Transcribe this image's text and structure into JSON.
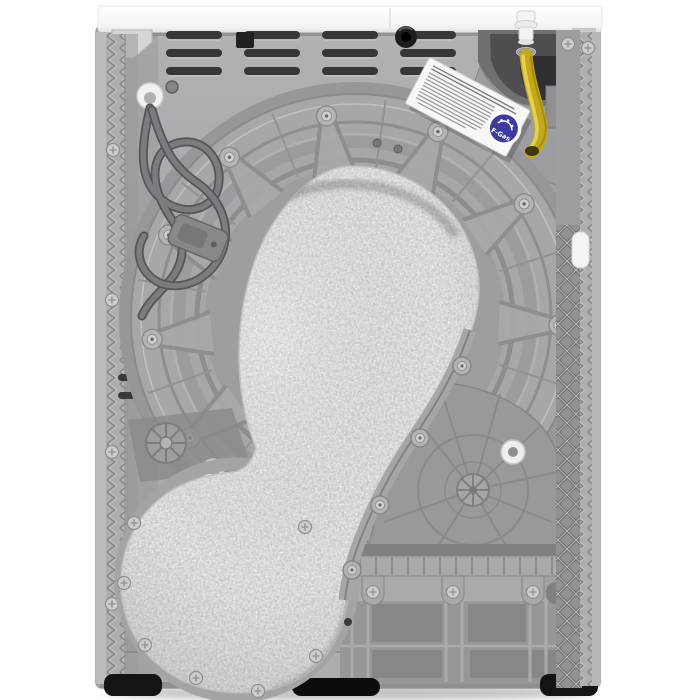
{
  "image": {
    "alt": "Rear view of a white freestanding tumble dryer: grey metal back panel with vent slots, large round drum housing covered by a grey felt air duct that sweeps down to a round felt pad at the lower left, coiled grey power cord on the upper left, yellow drain hose and dark heat-pump recess at the upper right, white specification sticker with a blue F-Gas badge, ribbed plastic base and black feet",
    "background": "#ffffff"
  },
  "badge": {
    "text": "F-Gas"
  },
  "colors": {
    "background": "#ffffff",
    "cabinet_white": "#f8f8f9",
    "back_panel": "#a9a9ab",
    "drum_ring": "#a7a7a9",
    "felt_pad": "#d9d9d9",
    "drain_hose": "#c3a81c",
    "fgas_badge": "#3d3aa3",
    "recess_dark": "#4e4e50",
    "feet_black": "#141416"
  }
}
